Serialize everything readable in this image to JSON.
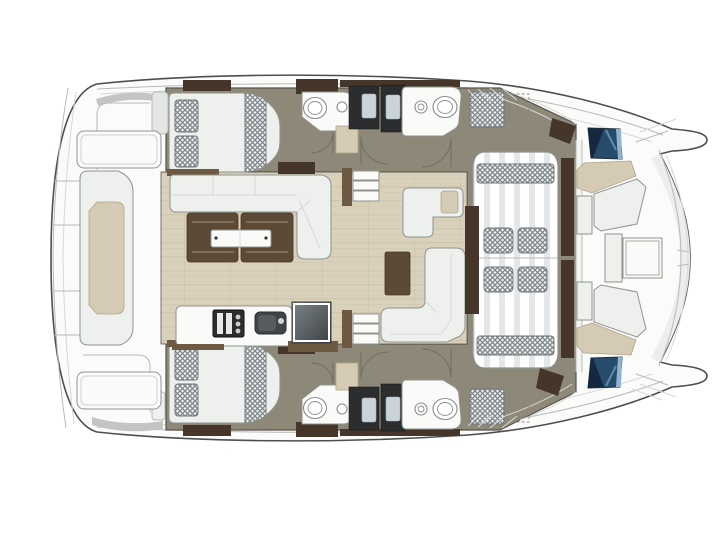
{
  "meta": {
    "alt": "Catamaran interior layout floor plan, top view, no text labels",
    "view": "top-down deck and hull accommodation plan"
  },
  "colors": {
    "pageBg": "#ffffff",
    "deckWhite": "#fbfbfa",
    "outline": "#4e4f4d",
    "interiorLine": "#57544c",
    "seam": "#b7bbb7",
    "seamLight": "#d6d9d6",
    "bulwarkBand": "#eceeec",
    "floorTaupe": "#8d8878",
    "floorStreak": "#a39d8c",
    "floorWoodBase": "#d9d1bc",
    "woodGrainLine": "#c8bfa4",
    "furnWhite": "#eef0ee",
    "furnEdge": "#8f948f",
    "walnut": "#5c4936",
    "walnutDark": "#46362a",
    "woodTrim": "#6e5a42",
    "beige": "#d5cbb5",
    "beigeEdge": "#ada387",
    "charcoal": "#2c2d2e",
    "glassBlue": "#c9d4da",
    "checkBg": "#eef0f0",
    "checkLine": "#7f8689",
    "checkEdge": "#6d7376",
    "stripe": "#e3e7e8",
    "hatchNavy": "#274b6b",
    "hatchNavyDark": "#14293f",
    "hatchLight": "#8fb3d1",
    "applianceTop": "#7d8487",
    "applianceBottom": "#3c4144",
    "porcelain": "#8a8f8c",
    "doorArc": "#6f6b62",
    "graniteSink": "#3f4447"
  },
  "inventory": {
    "double_berths": 2,
    "berth_pillows": 4,
    "bathrooms": 4,
    "toilets": 4,
    "wash_basins": 4,
    "shower_stalls": 4,
    "companionway_stairs": 2,
    "saloon_sofas": 3,
    "saloon_table_leaves": 2,
    "ottoman": 1,
    "galley_stove": 1,
    "galley_sink": 1,
    "tv_unit": 1,
    "cockpit_sunpad_cushions": 4,
    "forward_cockpit_table": 1,
    "bow_hatches": 2,
    "transom_steps": 2
  }
}
